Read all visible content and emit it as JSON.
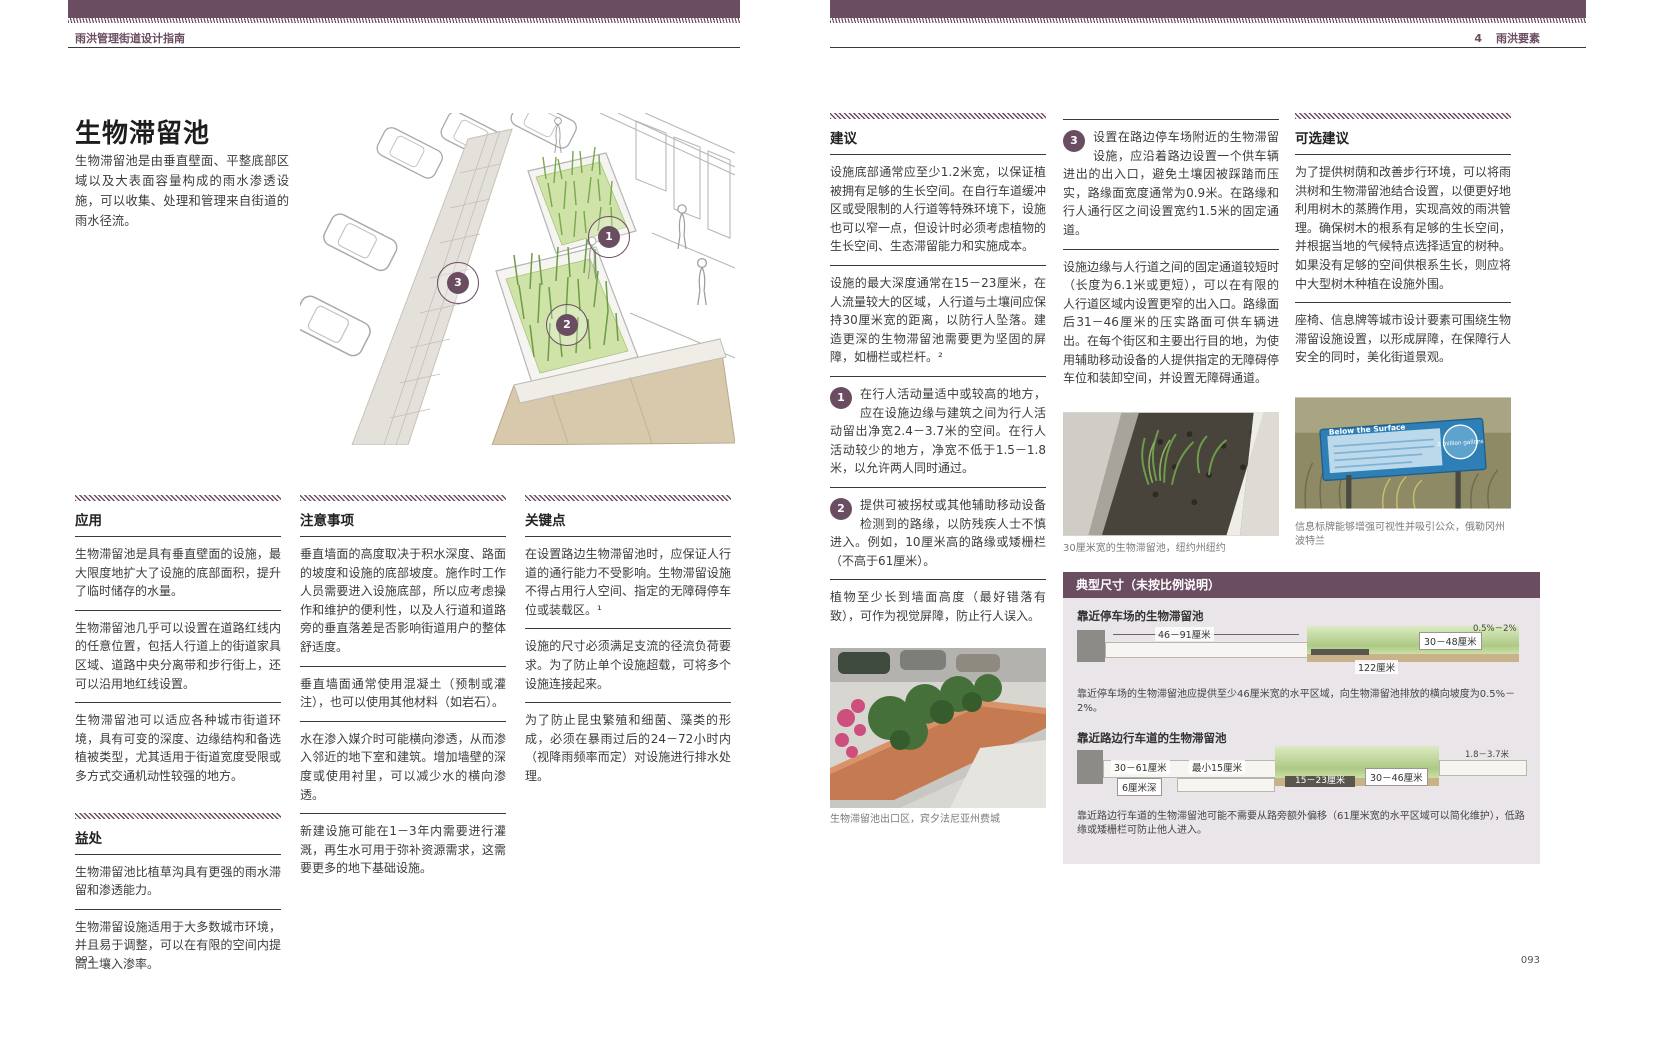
{
  "colors": {
    "accent": "#6b4d62",
    "panel_bg": "#e9e5e8",
    "text": "#3c3c3c"
  },
  "left_page": {
    "header": "雨洪管理街道设计指南",
    "page_number": "092",
    "title": "生物滞留池",
    "intro": "生物滞留池是由垂直壁面、平整底部区域以及大表面容量构成的雨水渗透设施，可以收集、处理和管理来自街道的雨水径流。",
    "figure_markers": [
      "1",
      "2",
      "3"
    ],
    "col1": {
      "s1_heading": "应用",
      "s1_p1": "生物滞留池是具有垂直壁面的设施，最大限度地扩大了设施的底部面积，提升了临时储存的水量。",
      "s1_p2": "生物滞留池几乎可以设置在道路红线内的任意位置，包括人行道上的街道家具区域、道路中央分离带和步行街上，还可以沿用地红线设置。",
      "s1_p3": "生物滞留池可以适应各种城市街道环境，具有可变的深度、边缘结构和备选植被类型，尤其适用于街道宽度受限或多方式交通机动性较强的地方。",
      "s2_heading": "益处",
      "s2_p1": "生物滞留池比植草沟具有更强的雨水滞留和渗透能力。",
      "s2_p2": "生物滞留设施适用于大多数城市环境，并且易于调整，可以在有限的空间内提高土壤入渗率。"
    },
    "col2": {
      "heading": "注意事项",
      "p1": "垂直墙面的高度取决于积水深度、路面的坡度和设施的底部坡度。施作时工作人员需要进入设施底部，所以应考虑操作和维护的便利性，以及人行道和道路旁的垂直落差是否影响街道用户的整体舒适度。",
      "p2": "垂直墙面通常使用混凝土（预制或灌注），也可以使用其他材料（如岩石）。",
      "p3": "水在渗入媒介时可能横向渗透，从而渗入邻近的地下室和建筑。增加墙壁的深度或使用衬里，可以减少水的横向渗透。",
      "p4": "新建设施可能在1－3年内需要进行灌溉，再生水可用于弥补资源需求，这需要更多的地下基础设施。"
    },
    "col3": {
      "heading": "关键点",
      "p1": "在设置路边生物滞留池时，应保证人行道的通行能力不受影响。生物滞留设施不得占用行人空间、指定的无障碍停车位或装载区。¹",
      "p2": "设施的尺寸必须满足支流的径流负荷要求。为了防止单个设施超载，可将多个设施连接起来。",
      "p3": "为了防止昆虫繁殖和细菌、藻类的形成，必须在暴雨过后的24－72小时内（视降雨频率而定）对设施进行排水处理。"
    }
  },
  "right_page": {
    "header_chapter": "4",
    "header": "雨洪要素",
    "page_number": "093",
    "col1": {
      "heading": "建议",
      "p1": "设施底部通常应至少1.2米宽，以保证植被拥有足够的生长空间。在自行车道缓冲区或受限制的人行道等特殊环境下，设施也可以窄一点，但设计时必须考虑植物的生长空间、生态滞留能力和实施成本。",
      "p2": "设施的最大深度通常在15－23厘米，在人流量较大的区域，人行道与土壤间应保持30厘米宽的距离，以防行人坠落。建造更深的生物滞留池需要更为坚固的屏障，如栅栏或栏杆。²",
      "n1_num": "1",
      "n1_text": "在行人活动量适中或较高的地方，应在设施边缘与建筑之间为行人活动留出净宽2.4－3.7米的空间。在行人活动较少的地方，净宽不低于1.5－1.8米，以允许两人同时通过。",
      "n2_num": "2",
      "n2_text": "提供可被拐杖或其他辅助移动设备检测到的路缘，以防残疾人士不慎进入。例如，10厘米高的路缘或矮栅栏（不高于61厘米）。",
      "p3": "植物至少长到墙面高度（最好错落有致），可作为视觉屏障，防止行人误入。",
      "photo_caption": "生物滞留池出口区，宾夕法尼亚州费城"
    },
    "col2": {
      "n3_num": "3",
      "n3_text": "设置在路边停车场附近的生物滞留设施，应沿着路边设置一个供车辆进出的出入口，避免土壤因被踩踏而压实，路缘面宽度通常为0.9米。在路缘和行人通行区之间设置宽约1.5米的固定通道。",
      "p1": "设施边缘与人行道之间的固定通道较短时（长度为6.1米或更短），可以在有限的人行道区域内设置更窄的出入口。路缘面后31－46厘米的压实路面可供车辆进出。在每个街区和主要出行目的地，为使用辅助移动设备的人提供指定的无障碍停车位和装卸空间，并设置无障碍通道。",
      "photo_caption": "30厘米宽的生物滞留池，纽约州纽约"
    },
    "col3": {
      "heading": "可选建议",
      "p1": "为了提供树荫和改善步行环境，可以将雨洪树和生物滞留池结合设置，以便更好地利用树木的蒸腾作用，实现高效的雨洪管理。确保树木的根系有足够的生长空间，并根据当地的气候特点选择适宜的树种。如果没有足够的空间供根系生长，则应将中大型树木种植在设施外围。",
      "p2": "座椅、信息牌等城市设计要素可围绕生物滞留设施设置，以形成屏障，在保障行人安全的同时，美化街道景观。",
      "photo_caption": "信息标牌能够增强可视性并吸引公众，俄勒冈州波特兰",
      "sign_title": "Below the Surface",
      "sign_value": "2 million gallons"
    },
    "dims": {
      "box_title": "典型尺寸（未按比例说明）",
      "d1_title": "靠近停车场的生物滞留池",
      "d1_label1": "46－91厘米",
      "d1_label2": "122厘米",
      "d1_label3": "30－48厘米",
      "d1_label4": "0.5%－2%",
      "d1_note": "靠近停车场的生物滞留池应提供至少46厘米宽的水平区域，向生物滞留池排放的横向坡度为0.5%－2%。",
      "d2_title": "靠近路边行车道的生物滞留池",
      "d2_label1": "30－61厘米",
      "d2_label2": "最小15厘米",
      "d2_label3": "6厘米深",
      "d2_label4": "15－23厘米",
      "d2_label5": "30－46厘米",
      "d2_label6": "1.8－3.7米",
      "d2_note": "靠近路边行车道的生物滞留池可能不需要从路旁额外偏移（61厘米宽的水平区域可以简化维护），低路缘或矮栅栏可防止他人进入。"
    }
  }
}
